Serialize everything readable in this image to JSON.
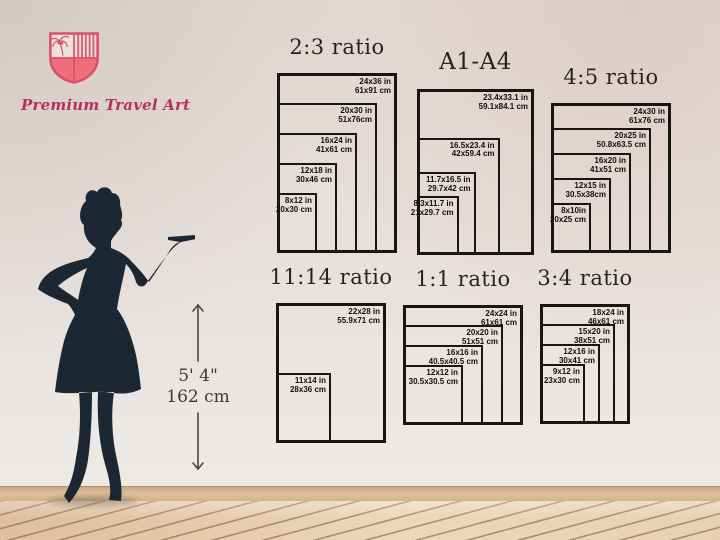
{
  "brand": {
    "name": "Premium Travel Art"
  },
  "reference": {
    "height_imperial": "5' 4\"",
    "height_metric": "162 cm"
  },
  "diagrams": [
    {
      "title": "2:3 ratio",
      "sizes": [
        {
          "w": 24,
          "h": 36,
          "in": "24x36 in",
          "cm": "61x91 cm"
        },
        {
          "w": 20,
          "h": 30,
          "in": "20x30 in",
          "cm": "51x76cm"
        },
        {
          "w": 16,
          "h": 24,
          "in": "16x24 in",
          "cm": "41x61 cm"
        },
        {
          "w": 12,
          "h": 18,
          "in": "12x18 in",
          "cm": "30x46 cm"
        },
        {
          "w": 8,
          "h": 12,
          "in": "8x12 in",
          "cm": "20x30 cm"
        }
      ]
    },
    {
      "title": "A1-A4",
      "sizes": [
        {
          "w": 23.4,
          "h": 33.1,
          "in": "23.4x33.1 in",
          "cm": "59.1x84.1 cm"
        },
        {
          "w": 16.5,
          "h": 23.4,
          "in": "16.5x23.4 in",
          "cm": "42x59.4 cm"
        },
        {
          "w": 11.7,
          "h": 16.5,
          "in": "11.7x16.5 in",
          "cm": "29.7x42 cm"
        },
        {
          "w": 8.3,
          "h": 11.7,
          "in": "8.3x11.7 in",
          "cm": "21x29.7 cm"
        }
      ]
    },
    {
      "title": "4:5 ratio",
      "sizes": [
        {
          "w": 24,
          "h": 30,
          "in": "24x30 in",
          "cm": "61x76 cm"
        },
        {
          "w": 20,
          "h": 25,
          "in": "20x25 in",
          "cm": "50.8x63.5 cm"
        },
        {
          "w": 16,
          "h": 20,
          "in": "16x20 in",
          "cm": "41x51 cm"
        },
        {
          "w": 12,
          "h": 15,
          "in": "12x15 in",
          "cm": "30.5x38cm"
        },
        {
          "w": 8,
          "h": 10,
          "in": "8x10in",
          "cm": "20x25 cm"
        }
      ]
    },
    {
      "title": "11:14 ratio",
      "sizes": [
        {
          "w": 22,
          "h": 28,
          "in": "22x28 in",
          "cm": "55.9x71 cm"
        },
        {
          "w": 11,
          "h": 14,
          "in": "11x14 in",
          "cm": "28x36 cm"
        }
      ]
    },
    {
      "title": "1:1 ratio",
      "sizes": [
        {
          "w": 24,
          "h": 24,
          "in": "24x24 in",
          "cm": "61x61 cm"
        },
        {
          "w": 20,
          "h": 20,
          "in": "20x20 in",
          "cm": "51x51 cm"
        },
        {
          "w": 16,
          "h": 16,
          "in": "16x16 in",
          "cm": "40.5x40.5 cm"
        },
        {
          "w": 12,
          "h": 12,
          "in": "12x12 in",
          "cm": "30.5x30.5 cm"
        }
      ]
    },
    {
      "title": "3:4 ratio",
      "sizes": [
        {
          "w": 18,
          "h": 24,
          "in": "18x24 in",
          "cm": "46x61 cm"
        },
        {
          "w": 15,
          "h": 20,
          "in": "15x20 in",
          "cm": "38x51 cm"
        },
        {
          "w": 12,
          "h": 16,
          "in": "12x16 in",
          "cm": "30x41 cm"
        },
        {
          "w": 9,
          "h": 12,
          "in": "9x12 in",
          "cm": "23x30 cm"
        }
      ]
    }
  ],
  "colors": {
    "brand_pink": "#b5305f",
    "shield_crimson": "#d94f6d",
    "shield_fill": "#ef6f79",
    "silhouette_navy": "#1c2734",
    "box_line": "#161616",
    "wall": "#e6dfdb",
    "floor_wood": "#ecd7bb",
    "floor_line": "#7e5236"
  }
}
